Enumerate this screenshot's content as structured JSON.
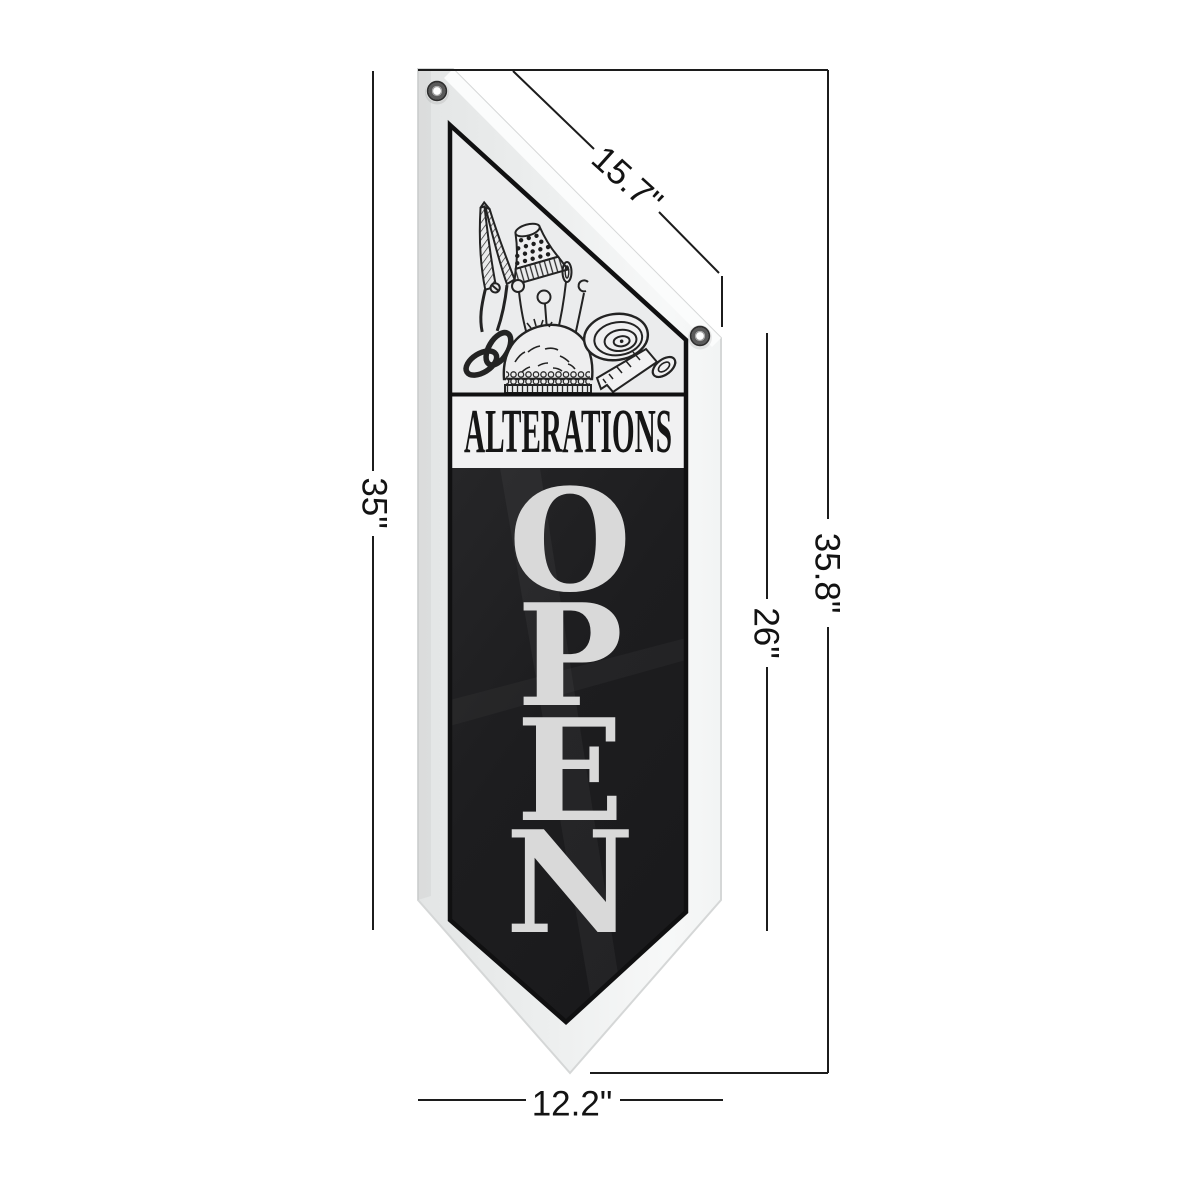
{
  "page": {
    "background": "#ffffff"
  },
  "banner": {
    "heading": "ALTERATIONS",
    "open_letters": [
      "O",
      "P",
      "E",
      "N"
    ],
    "colors": {
      "fabric_light": "#eef0f0",
      "panel_black": "#1d1d1f",
      "open_text": "#d9d9d9",
      "heading_text": "#151515",
      "panel_outline": "#101011"
    },
    "illustration_items": [
      "scissors",
      "thimble",
      "ball-pins",
      "curl-pin",
      "needle",
      "pin-cushion",
      "measuring-tape",
      "button"
    ]
  },
  "dimensions": {
    "line_color": "#1c1c1c",
    "label_color": "#131313",
    "top_diagonal": "15.7\"",
    "left_height": "35\"",
    "right_inner_height": "26\"",
    "right_total_height": "35.8\"",
    "bottom_width": "12.2\""
  }
}
